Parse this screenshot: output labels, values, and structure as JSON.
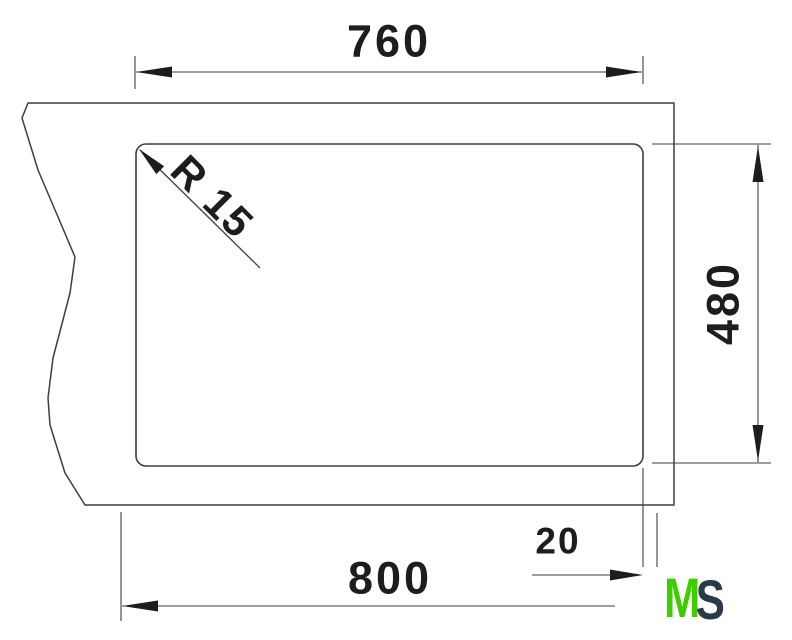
{
  "title": "Sink cutout installation drawing",
  "dimensions": {
    "cutout_width": "760",
    "cutout_depth": "480",
    "sink_width": "800",
    "edge_offset": "20",
    "corner_radius": "R 15"
  },
  "logo": {
    "letter_m": "M",
    "letter_s": "S"
  },
  "colors": {
    "line": "#3e3e3e",
    "text": "#1d1d1b",
    "logo_green": "#3fcc00",
    "logo_navy": "#2b3a4a",
    "background": "#ffffff"
  }
}
